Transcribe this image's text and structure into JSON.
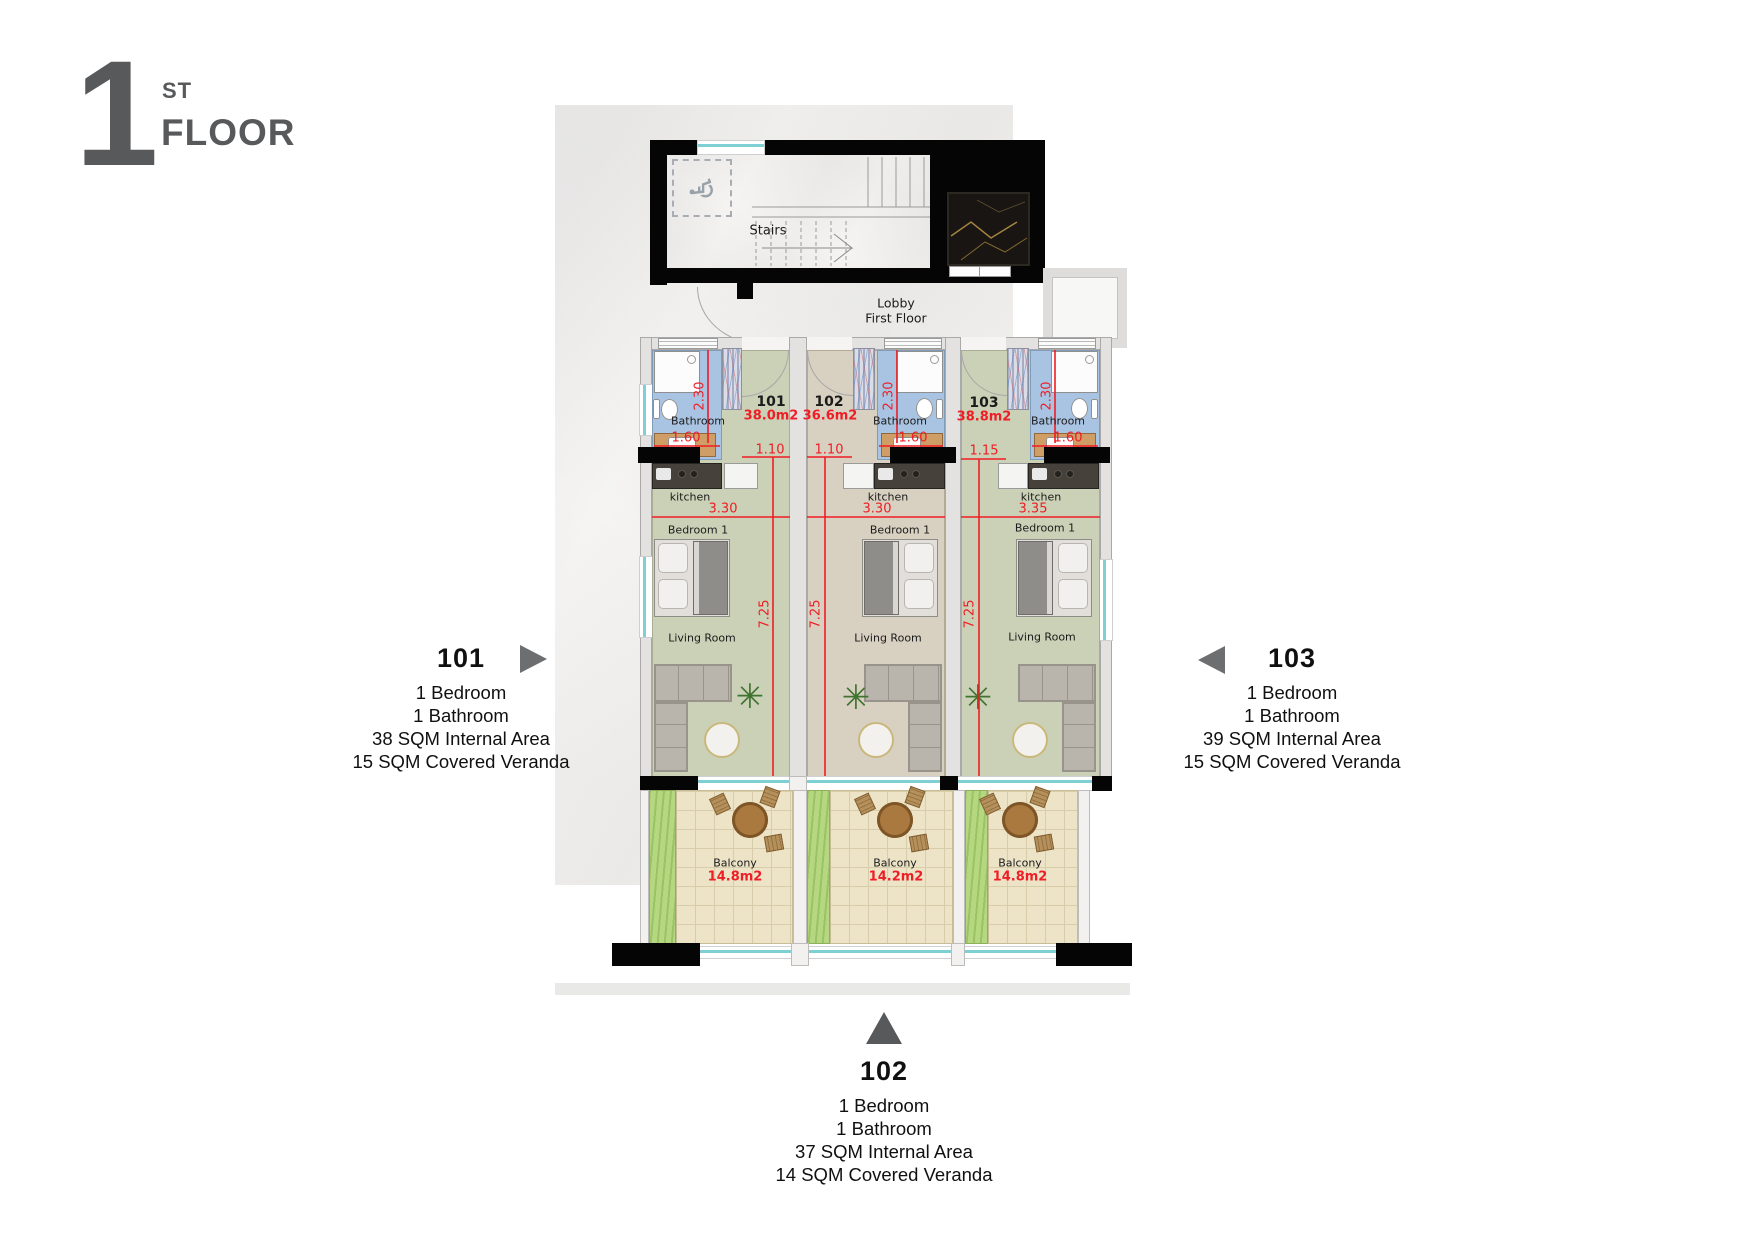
{
  "header": {
    "number": "1",
    "ordinal": "ST",
    "word": "FLOOR"
  },
  "plan": {
    "stairs_label": "Stairs",
    "lobby_label_line1": "Lobby",
    "lobby_label_line2": "First Floor",
    "units": [
      {
        "id": "101",
        "internal_area": "38.0m2",
        "bathroom_label": "Bathroom",
        "kitchen_label": "kitchen",
        "bedroom_label": "Bedroom 1",
        "living_room_label": "Living Room",
        "balcony_label": "Balcony",
        "balcony_area": "14.8m2",
        "dims": {
          "bath_depth": "2.30",
          "bath_width": "1.60",
          "entry_width": "1.10",
          "unit_width": "3.30",
          "unit_length": "7.25"
        }
      },
      {
        "id": "102",
        "internal_area": "36.6m2",
        "bathroom_label": "Bathroom",
        "kitchen_label": "kitchen",
        "bedroom_label": "Bedroom 1",
        "living_room_label": "Living Room",
        "balcony_label": "Balcony",
        "balcony_area": "14.2m2",
        "dims": {
          "bath_depth": "2.30",
          "bath_width": "1.60",
          "entry_width": "1.10",
          "unit_width": "3.30",
          "unit_length": "7.25"
        }
      },
      {
        "id": "103",
        "internal_area": "38.8m2",
        "bathroom_label": "Bathroom",
        "kitchen_label": "kitchen",
        "bedroom_label": "Bedroom 1",
        "living_room_label": "Living Room",
        "balcony_label": "Balcony",
        "balcony_area": "14.8m2",
        "dims": {
          "bath_depth": "2.30",
          "bath_width": "1.60",
          "entry_width": "1.15",
          "unit_width": "3.35",
          "unit_length": "7.25"
        }
      }
    ]
  },
  "callouts": {
    "left": {
      "unit_id": "101",
      "lines": [
        "1 Bedroom",
        "1 Bathroom",
        "38 SQM Internal Area",
        "15 SQM Covered Veranda"
      ]
    },
    "right": {
      "unit_id": "103",
      "lines": [
        "1 Bedroom",
        "1 Bathroom",
        "39 SQM Internal Area",
        "15 SQM Covered Veranda"
      ]
    },
    "bottom": {
      "unit_id": "102",
      "lines": [
        "1 Bedroom",
        "1 Bathroom",
        "37 SQM Internal Area",
        "14 SQM Covered Veranda"
      ]
    }
  },
  "icons": {
    "wheelchair": "♿",
    "plant": "✳"
  },
  "colors": {
    "dimension_red": "#ef1d25",
    "callout_arrow_gray": "#6d6e70",
    "floor_green": "#cbd1b6",
    "floor_beige": "#d8d0c0",
    "bathroom_blue": "#a9c4e2",
    "window_teal": "#7fd0d4",
    "balcony_tile": "#ede4c8",
    "balcony_grass": "#b5d77f"
  }
}
